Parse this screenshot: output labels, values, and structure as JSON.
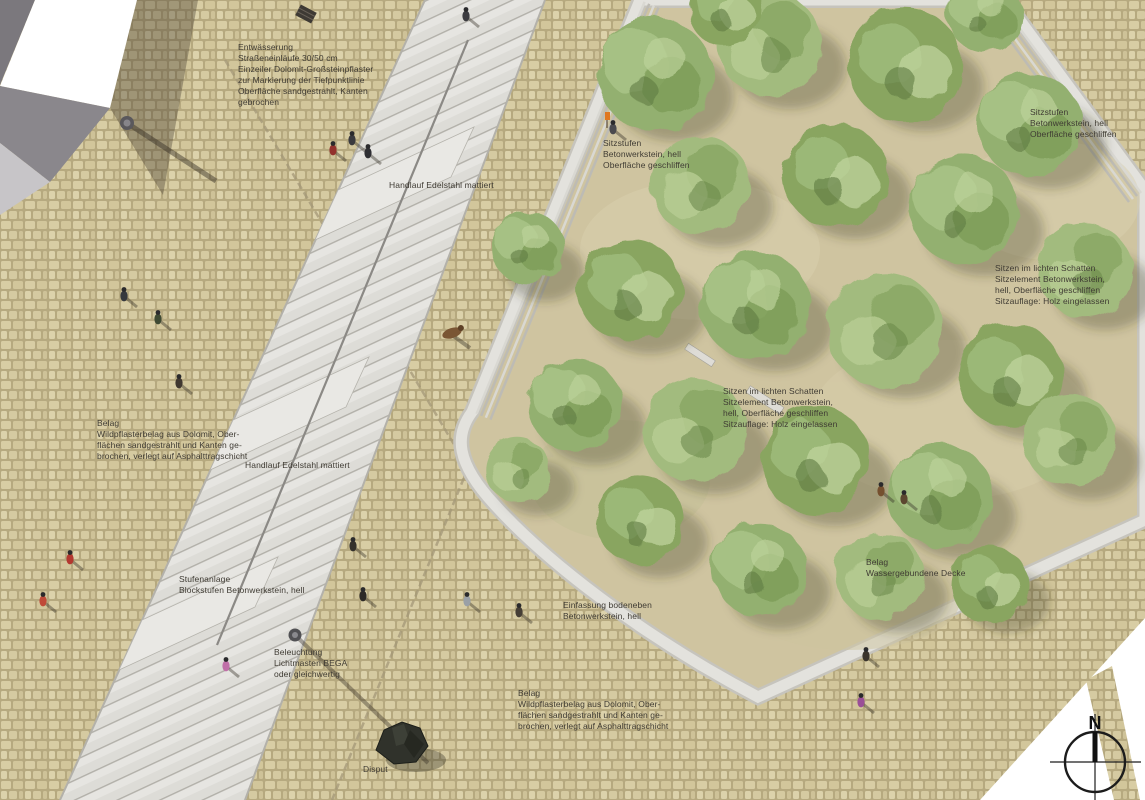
{
  "annotations": {
    "entwaesserung": "Entwässerung\nStraßeneinläufe 30/50 cm\nEinzeiler Dolomit-Großsteinpflaster\nzur Markierung der Tiefpunktlinie\nOberfläche sandgestrahlt, Kanten\ngebrochen",
    "handlauf_oben": "Handlauf Edelstahl mattiert",
    "sitzstufen_links": "Sitzstufen\nBetonwerkstein, hell\nOberfläche geschliffen",
    "sitzstufen_rechts": "Sitzstufen\nBetonwerkstein, hell\nOberfläche geschliffen",
    "sitzen_rechts": "Sitzen im lichten Schatten\nSitzelement Betonwerkstein,\nhell, Oberfläche geschliffen\nSitzauflage: Holz eingelassen",
    "sitzen_mitte": "Sitzen im lichten Schatten\nSitzelement Betonwerkstein,\nhell, Oberfläche geschliffen\nSitzauflage: Holz eingelassen",
    "belag_links": "Belag\nWildpflasterbelag aus Dolomit, Ober-\nflächen sandgestrahlt und Kanten ge-\nbrochen, verlegt auf Asphalttragschicht",
    "handlauf_unten": "Handlauf Edelstahl mattiert",
    "belag_wassergebunden": "Belag\nWassergebundene Decke",
    "einfassung": "Einfassung bodeneben\nBetonwerkstein, hell",
    "stufenanlage": "Stufenanlage\nBlockstufen Betonwerkstein, hell",
    "beleuchtung": "Beleuchtung\nLichtmasten BEGA\noder gleichwertig",
    "belag_unten": "Belag\nWildpflasterbelag aus Dolomit, Ober-\nflächen sandgestrahlt und Kanten ge-\nbrochen, verlegt auf Asphalttragschicht",
    "disput": "Disput"
  },
  "compass": {
    "north_label": "N"
  },
  "colors": {
    "paving": "#d6cba2",
    "grout": "#b4a77e",
    "stone_light": "#e4e3df",
    "sand": "#cfc4a0",
    "tree_green": "#8fae6d",
    "building_white": "#ffffff",
    "roof_gray": "#8a878c",
    "shadow": "rgba(70,63,50,0.38)"
  }
}
